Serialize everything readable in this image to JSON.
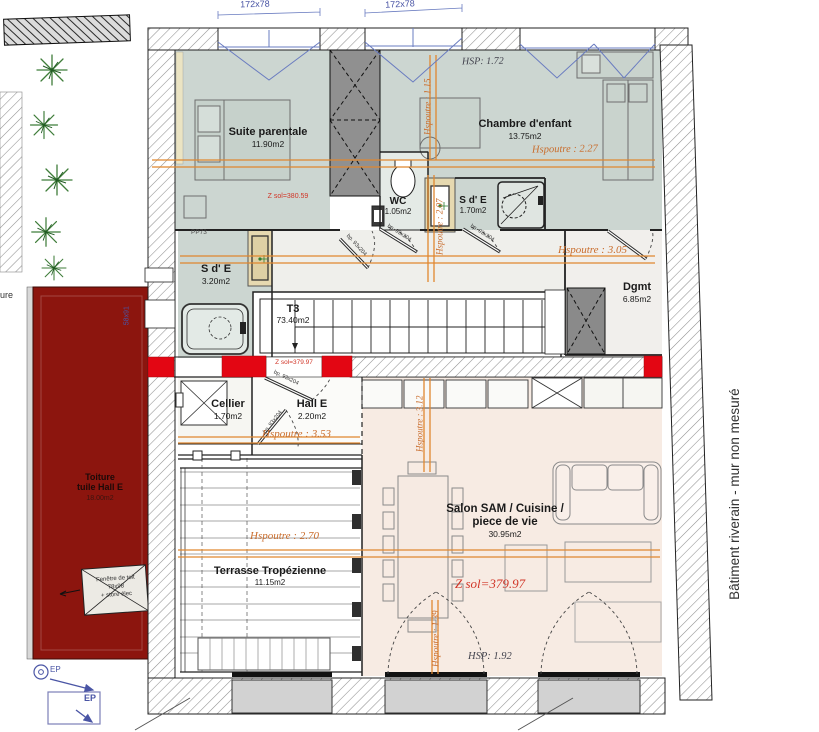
{
  "plan": {
    "windows": {
      "top_left_dim": "172x78",
      "top_right_dim": "172x78"
    },
    "rooms": {
      "suite_parentale": {
        "name": "Suite parentale",
        "area": "11.90m2"
      },
      "chambre_enfant": {
        "name": "Chambre d'enfant",
        "area": "13.75m2"
      },
      "wc": {
        "name": "WC",
        "area": "1.05m2"
      },
      "sde_chambre": {
        "name": "S d' E",
        "area": "1.70m2"
      },
      "sde_suite": {
        "name": "S d' E",
        "area": "3.20m2"
      },
      "degagement": {
        "name": "Dgmt",
        "area": "6.85m2"
      },
      "t3": {
        "name": "T3",
        "area": "73.40m2"
      },
      "cellier": {
        "name": "Cellier",
        "area": "1.70m2"
      },
      "hall": {
        "name": "Hall E",
        "area": "2.20m2"
      },
      "salon": {
        "line1": "Salon SAM / Cuisine /",
        "line2": "piece de vie",
        "area": "30.95m2"
      },
      "terrasse": {
        "name": "Terrasse Tropézienne",
        "area": "11.15m2"
      },
      "toiture": {
        "line1": "Toiture",
        "line2": "tuile Hall E",
        "area": "18.00m2"
      }
    },
    "heights": {
      "hsp_chambre": "HSP: 1.72",
      "hsp_salon": "HSP: 1.92",
      "hspoutre_chambre": "Hspoutre : 1.15",
      "hspoutre_chambre2": "Hspoutre : 2.27",
      "hspoutre_palier": "Hspoutre : 3.05",
      "hspoutre_sde": "Hspoutre : 2.07",
      "hspoutre_hall": "Hspoutre : 3.53",
      "hspoutre_terrasse": "Hspoutre : 2.70",
      "hspoutre_salon": "Hspoutre : 3.12",
      "hspoutre_salon2": "Hspoutre : 1.39"
    },
    "levels": {
      "z_suite": "Z sol=380.59",
      "z_palier": "Z sol=379.97",
      "z_salon": "Z sol=379.97"
    },
    "tags": {
      "pp73": "PP73",
      "door": "bp. 93x204",
      "roof_tag": "58x91",
      "fenetre_line1": "Fenêtre de toit",
      "fenetre_line2": "78x98",
      "fenetre_line3": "+ store élec",
      "ep": "EP",
      "left_edge": "ure"
    },
    "notes": {
      "batiment": "Bâtiment riverain - mur non mesuré"
    },
    "colors": {
      "room_fill": "#ccd6d1",
      "salon_fill": "#f7ebe3",
      "roof": "#8c150e",
      "marker_red": "#e30613",
      "beam": "#e0872f",
      "dim_blue": "#4a55a5"
    }
  }
}
